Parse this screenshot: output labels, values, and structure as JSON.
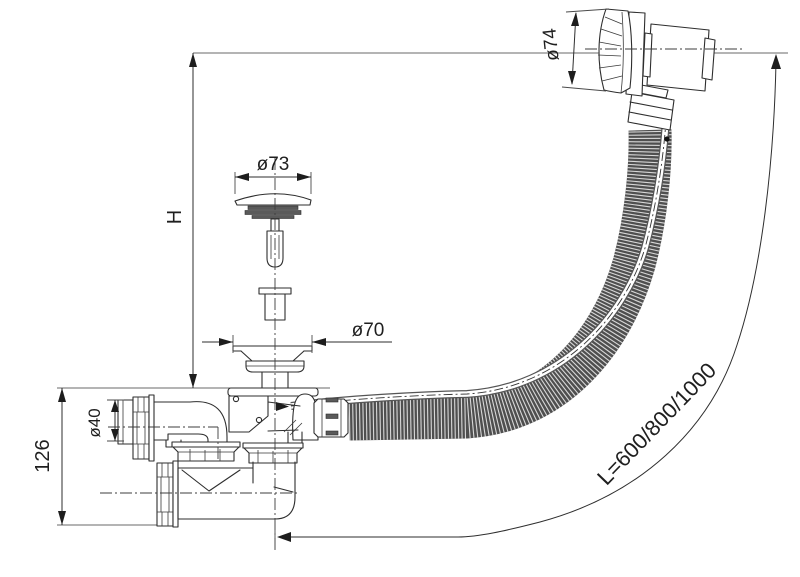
{
  "drawing": {
    "labels": {
      "height_ref": "H",
      "trap_height": "126",
      "outlet_diameter": "ø40",
      "strainer_diameter": "ø70",
      "plug_diameter": "ø73",
      "overflow_diameter": "ø74",
      "hose_length": "L=600/800/1000"
    },
    "colors": {
      "line": "#2e2e2e",
      "hose_dark": "#4f4f4f",
      "hose_rib": "#d8d8d8",
      "background": "#ffffff"
    }
  }
}
